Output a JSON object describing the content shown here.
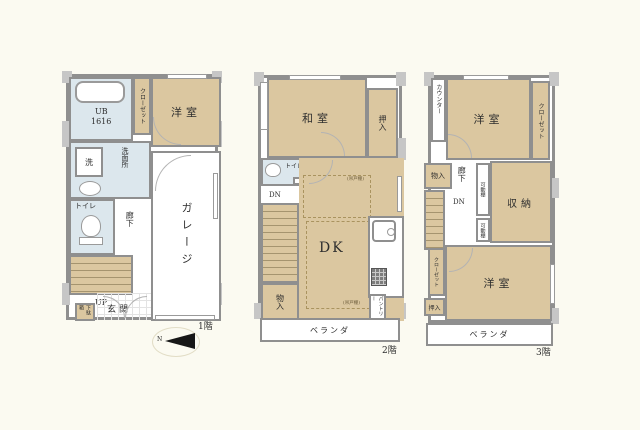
{
  "palette": {
    "room_tan": "#dbc7a0",
    "wet_blue": "#dce7ed",
    "wall_gray": "#8f8f8f",
    "pillar_gray": "#c6c6c6",
    "background": "#fbfaf1"
  },
  "f1": {
    "floor_label": "1階",
    "closet": "クローゼット",
    "yoshitsu": "洋室",
    "ub_line1": "UB",
    "ub_line2": "1616",
    "washer": "洗",
    "senmenjo": "洗面所",
    "toilet": "トイレ",
    "hallway": "廊下",
    "up": "UP",
    "getabako": "下駄箱",
    "genkan": "玄関",
    "garage": "ガレージ",
    "compass_n": "N"
  },
  "f2": {
    "floor_label": "2階",
    "washitsu": "和室",
    "oshiire": "押入",
    "toilet": "トイレ",
    "dn": "DN",
    "dk": "DK",
    "tsuridodana_top": "(吊戸棚)",
    "tsuridodana_bottom": "(吊戸棚)",
    "mononyu": "物入",
    "pantry": "パントリー",
    "veranda": "ベランダ"
  },
  "f3": {
    "floor_label": "3階",
    "counter": "カウンター",
    "yoshitsu_top": "洋室",
    "closet_top": "クローゼット",
    "mononyu": "物入",
    "hallway": "廊下",
    "dn": "DN",
    "movable_shelf_1": "可動棚",
    "movable_shelf_2": "可動棚",
    "shunou": "収納",
    "closet_bottom": "クローゼット",
    "oshiire": "押入",
    "yoshitsu_bottom": "洋室",
    "veranda": "ベランダ"
  }
}
